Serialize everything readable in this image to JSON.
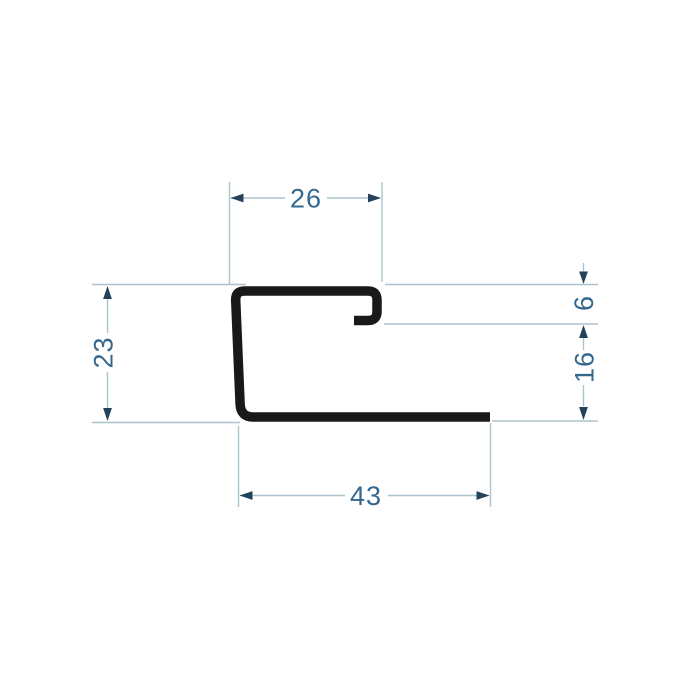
{
  "drawing": {
    "kind": "profile-cross-section-dimension-drawing",
    "dimensions": {
      "top_width": "26",
      "left_height": "23",
      "hook_depth": "6",
      "right_opening": "16",
      "bottom_width": "43"
    },
    "colors": {
      "background": "#ffffff",
      "profile": "#191919",
      "dim_line": "#aac3cc",
      "arrow": "#24425a",
      "dim_text": "#34688e"
    }
  }
}
